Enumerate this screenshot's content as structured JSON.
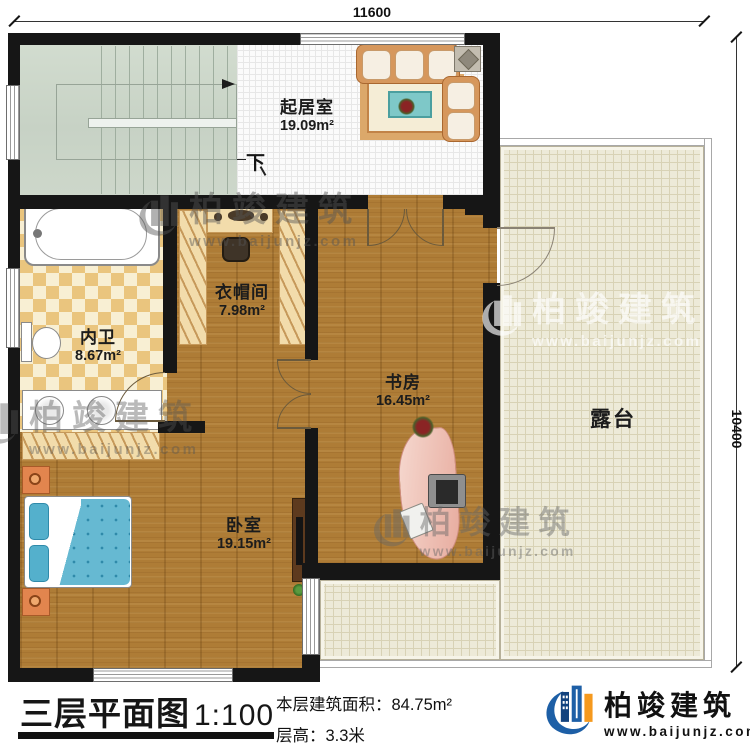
{
  "dimensions": {
    "top_width": "11600",
    "right_height": "10400"
  },
  "rooms": {
    "living": {
      "name": "起居室",
      "area": "19.09m²"
    },
    "cloakroom": {
      "name": "衣帽间",
      "area": "7.98m²"
    },
    "bathroom": {
      "name": "内卫",
      "area": "8.67m²"
    },
    "study": {
      "name": "书房",
      "area": "16.45m²"
    },
    "bedroom": {
      "name": "卧室",
      "area": "19.15m²"
    },
    "terrace": {
      "name": "露台"
    }
  },
  "stair": {
    "down_label": "下"
  },
  "footer": {
    "title": "三层平面图",
    "scale": "1:100",
    "area_line": "本层建筑面积：84.75m²",
    "height_line": "层高：3.3米"
  },
  "brand": {
    "name": "柏竣建筑",
    "url": "www.baijunjz.com",
    "logo_icon": "building-logo"
  },
  "watermark": {
    "name": "柏竣建筑",
    "url": "www.baijunjz.com"
  },
  "colors": {
    "wall": "#161616",
    "wood": "#ae7c36",
    "stair": "#cdd7ca",
    "terrace": "#edead8",
    "brand_blue": "#1d5fa6",
    "brand_orange": "#f5991e"
  }
}
